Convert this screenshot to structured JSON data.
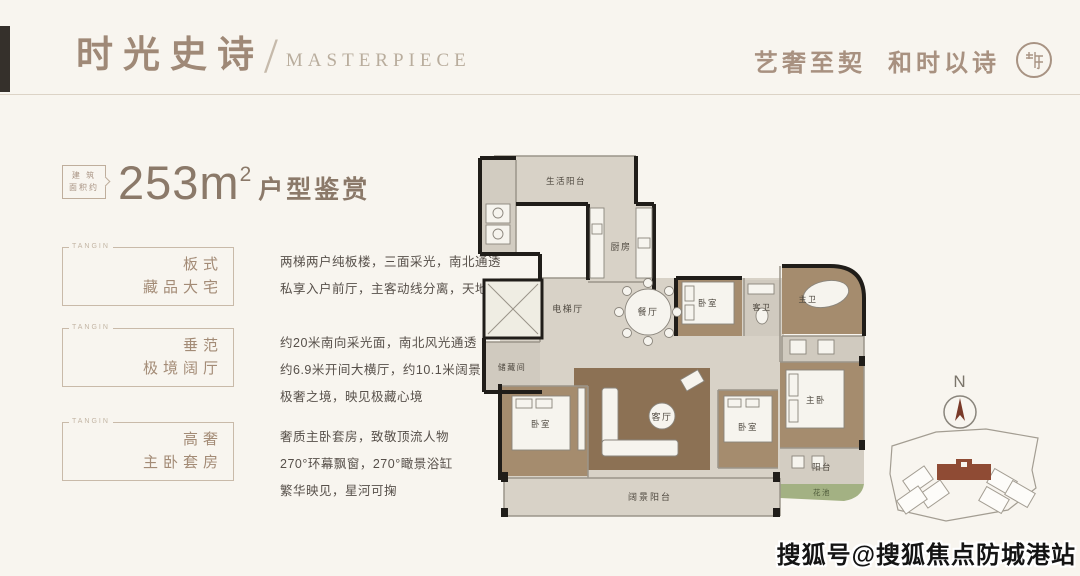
{
  "header": {
    "title_cn": "时光史诗",
    "divider": "/",
    "title_en": "MASTERPIECE",
    "tagline_left": "艺奢至契",
    "tagline_right": "和时以诗",
    "seal_icon": "brand-seal"
  },
  "area": {
    "tag_line1": "建 筑",
    "tag_line2": "面积约",
    "value": "253m",
    "superscript": "2",
    "suffix": "户型鉴赏"
  },
  "features": [
    {
      "brand": "TANGIN",
      "label_line1": "板式",
      "label_line2": "藏品大宅",
      "lines": [
        "两梯两户纯板楼，三面采光，南北通透",
        "私享入户前厅，主客动线分离，天地有别，与世界相安"
      ]
    },
    {
      "brand": "TANGIN",
      "label_line1": "垂范",
      "label_line2": "极境阔厅",
      "lines": [
        "约20米南向采光面，南北风光通透",
        "约6.9米开间大横厅，约10.1米阔景阳台",
        "极奢之境，映见极藏心境"
      ]
    },
    {
      "brand": "TANGIN",
      "label_line1": "高奢",
      "label_line2": "主卧套房",
      "lines": [
        "奢质主卧套房，致敬顶流人物",
        "270°环幕飘窗，270°瞰景浴缸",
        "繁华映见，星河可掬"
      ]
    }
  ],
  "floorplan": {
    "rooms": {
      "life_balcony": "生活阳台",
      "kitchen": "厨房",
      "elevator_hall": "电梯厅",
      "storage": "储藏间",
      "dining": "餐厅",
      "bedroom_a": "卧室",
      "guest_bath": "客卫",
      "master_bath": "主卫",
      "living": "客厅",
      "bedroom_b": "卧室",
      "bedroom_c": "卧室",
      "master_bedroom": "主卧",
      "balcony": "阳台",
      "flower_bed": "花池",
      "view_balcony": "阔景阳台"
    }
  },
  "compass": {
    "label": "N"
  },
  "watermark": "搜狐号@搜狐焦点防城港站",
  "colors": {
    "accent": "#9f8977",
    "wall": "#201d19",
    "room_brown": "#a58c6e",
    "wood": "#8c7154",
    "marble": "#d8d2c7",
    "flower_green": "#a3b183",
    "site_building": "#8f4b34"
  }
}
